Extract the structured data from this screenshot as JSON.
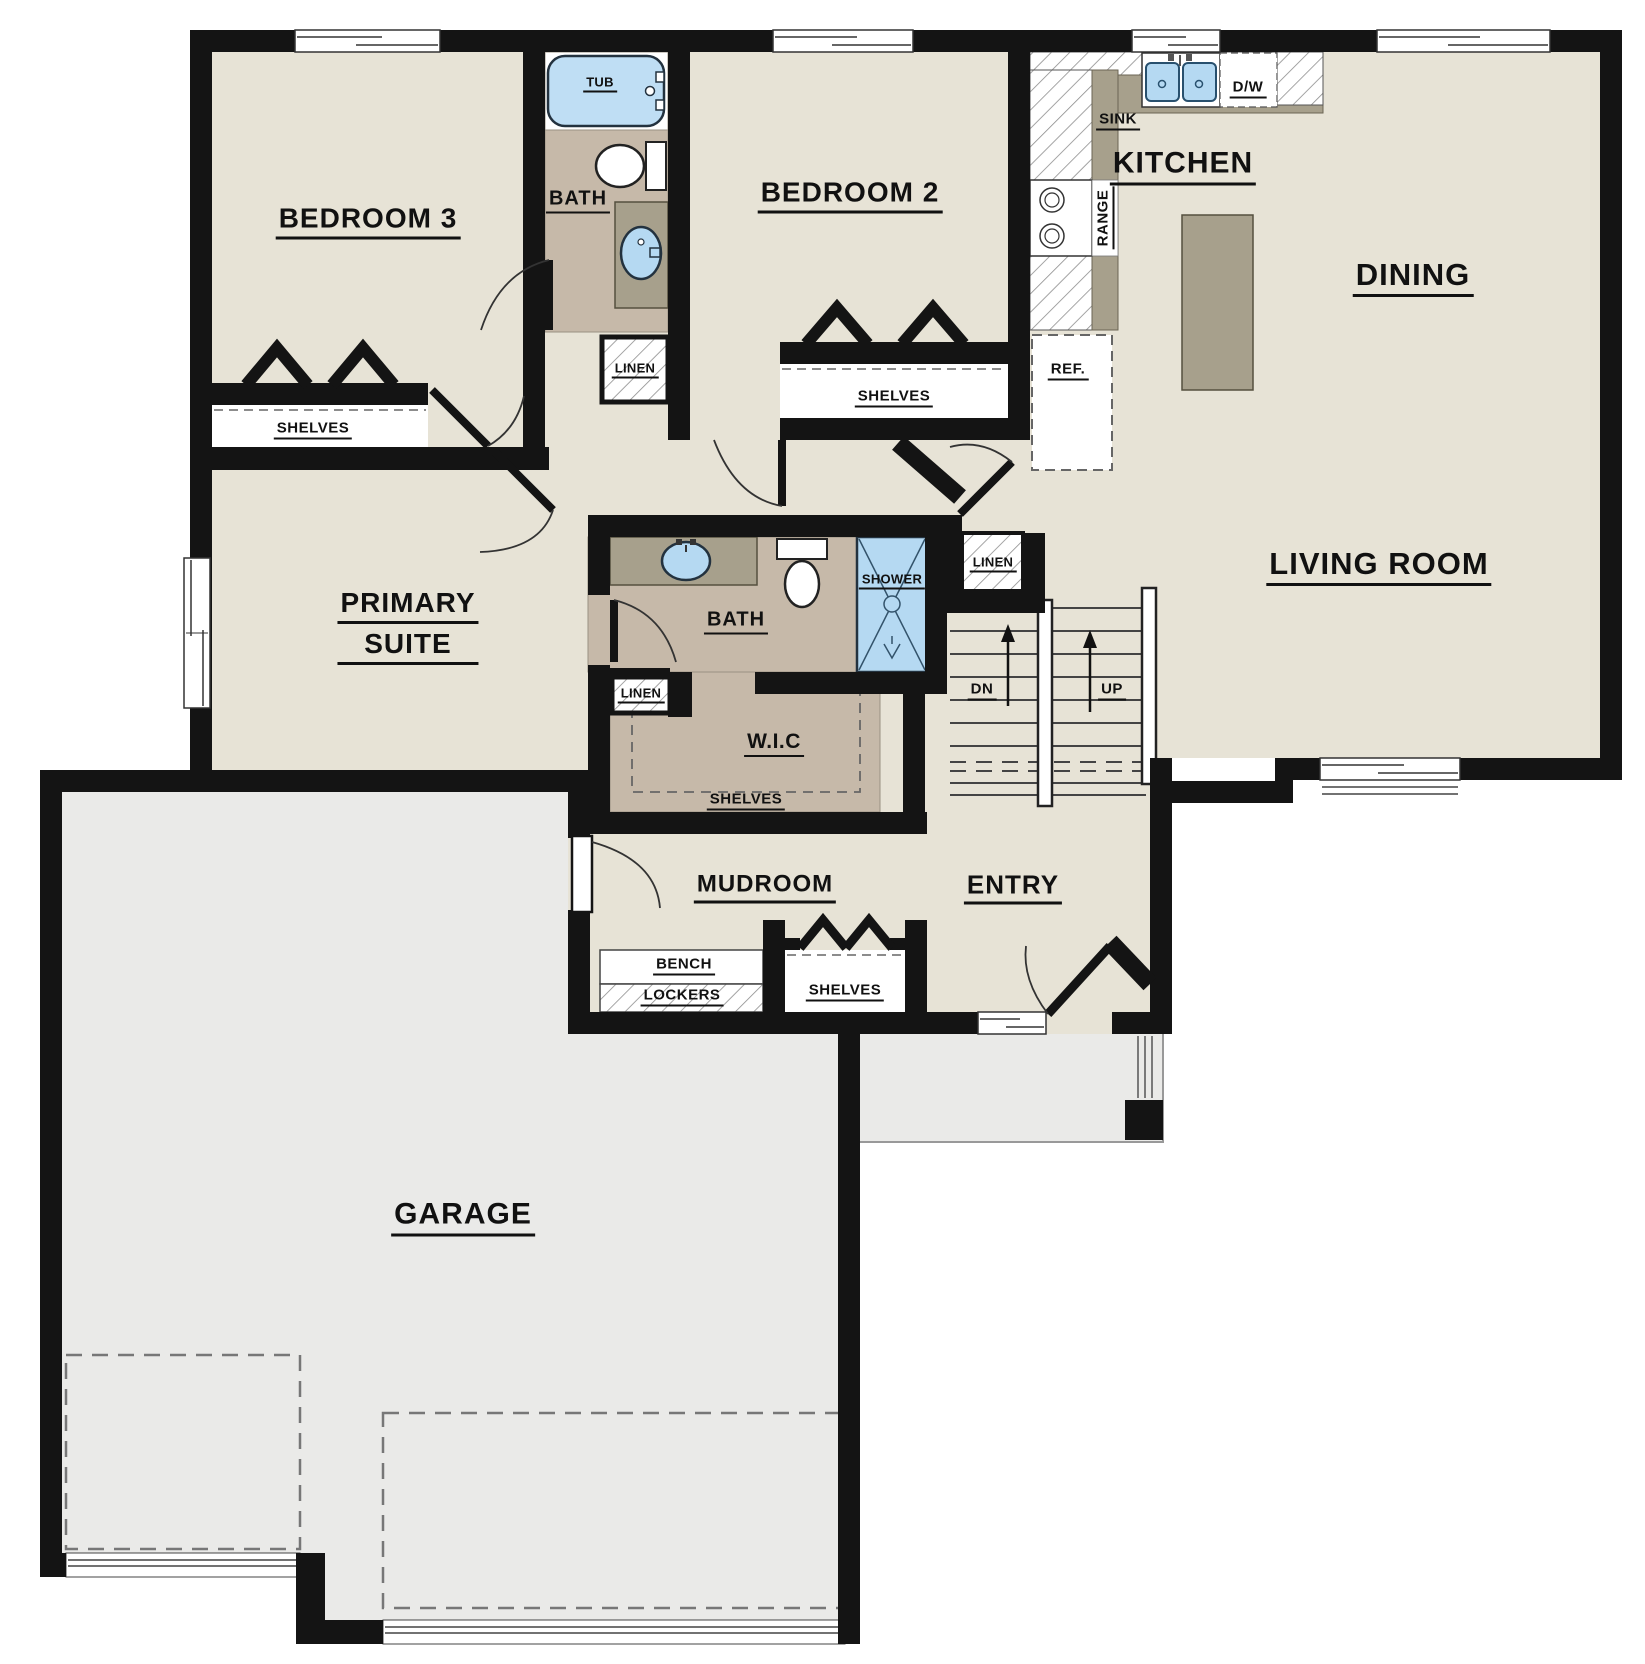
{
  "meta": {
    "type": "architectural-floor-plan",
    "floor": "main level",
    "canvas_width_px": 1645,
    "canvas_height_px": 1664
  },
  "colors": {
    "wall": "#141414",
    "floor": "#e7e3d6",
    "garage": "#eaeae8",
    "bathfloor": "#c6b9a9",
    "counter": "#a7a08c",
    "blue": "#b5d9f2",
    "ink": "#111111"
  },
  "rooms": {
    "bedroom3": {
      "label": "BEDROOM 3",
      "closet_label": "SHELVES"
    },
    "hall_bath": {
      "label": "BATH",
      "tub_label": "TUB",
      "linen_label": "LINEN"
    },
    "bedroom2": {
      "label": "BEDROOM 2",
      "closet_label": "SHELVES"
    },
    "kitchen": {
      "label": "KITCHEN",
      "sink_label": "SINK",
      "dishwasher_label": "D/W",
      "range_label": "RANGE",
      "fridge_label": "REF."
    },
    "dining": {
      "label": "DINING"
    },
    "living_room": {
      "label": "LIVING ROOM"
    },
    "primary_suite": {
      "label_line1": "PRIMARY",
      "label_line2": "SUITE"
    },
    "primary_bath": {
      "label": "BATH",
      "shower_label": "SHOWER",
      "linen_label": "LINEN"
    },
    "walk_in_closet": {
      "label": "W.I.C",
      "shelves_label": "SHELVES"
    },
    "stairs": {
      "down_label": "DN",
      "up_label": "UP",
      "linen_label": "LINEN"
    },
    "mudroom": {
      "label": "MUDROOM",
      "bench_label": "BENCH",
      "lockers_label": "LOCKERS",
      "closet_label": "SHELVES"
    },
    "entry": {
      "label": "ENTRY"
    },
    "garage": {
      "label": "GARAGE"
    }
  }
}
